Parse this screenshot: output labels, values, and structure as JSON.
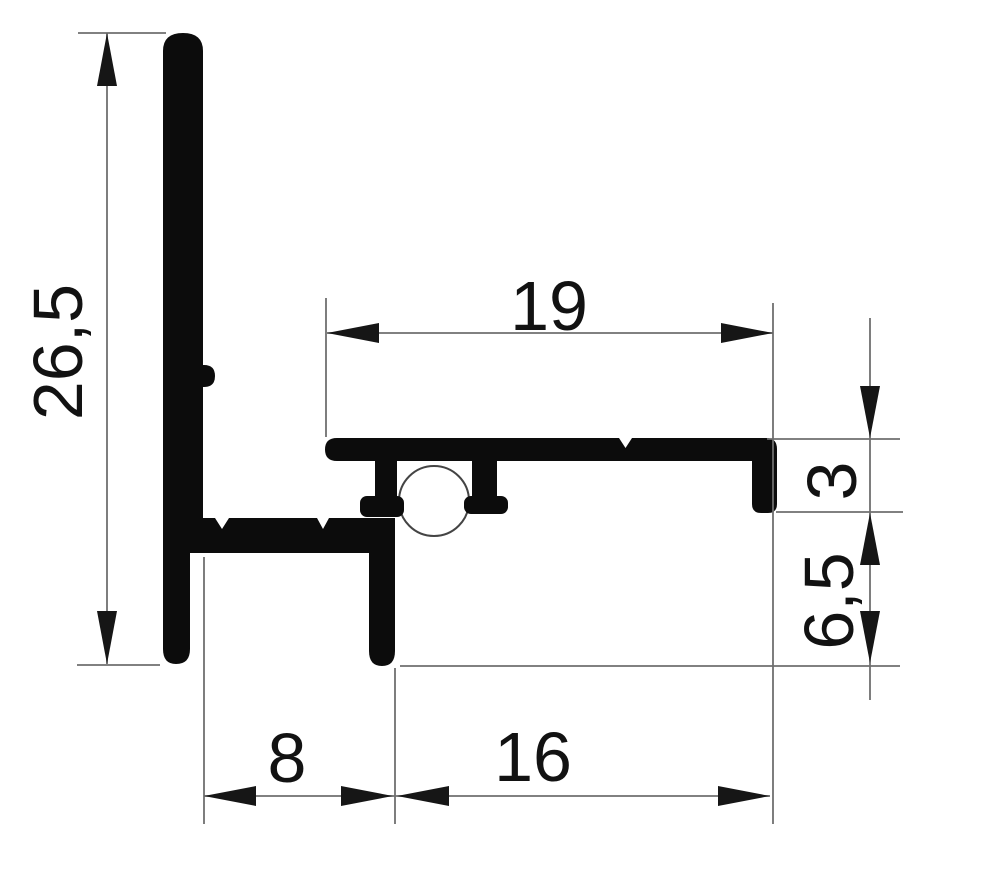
{
  "drawing": {
    "labels": {
      "overall_height": "26,5",
      "top_width": "19",
      "edge_height": "3",
      "leg_height": "6,5",
      "bottom_left_width": "8",
      "bottom_right_width": "16"
    },
    "colors": {
      "background": "#ffffff",
      "profile": "#0c0c0c",
      "line": "#6f6f6f",
      "gasket": "#444444",
      "arrow": "#161616",
      "text": "#121212"
    }
  }
}
